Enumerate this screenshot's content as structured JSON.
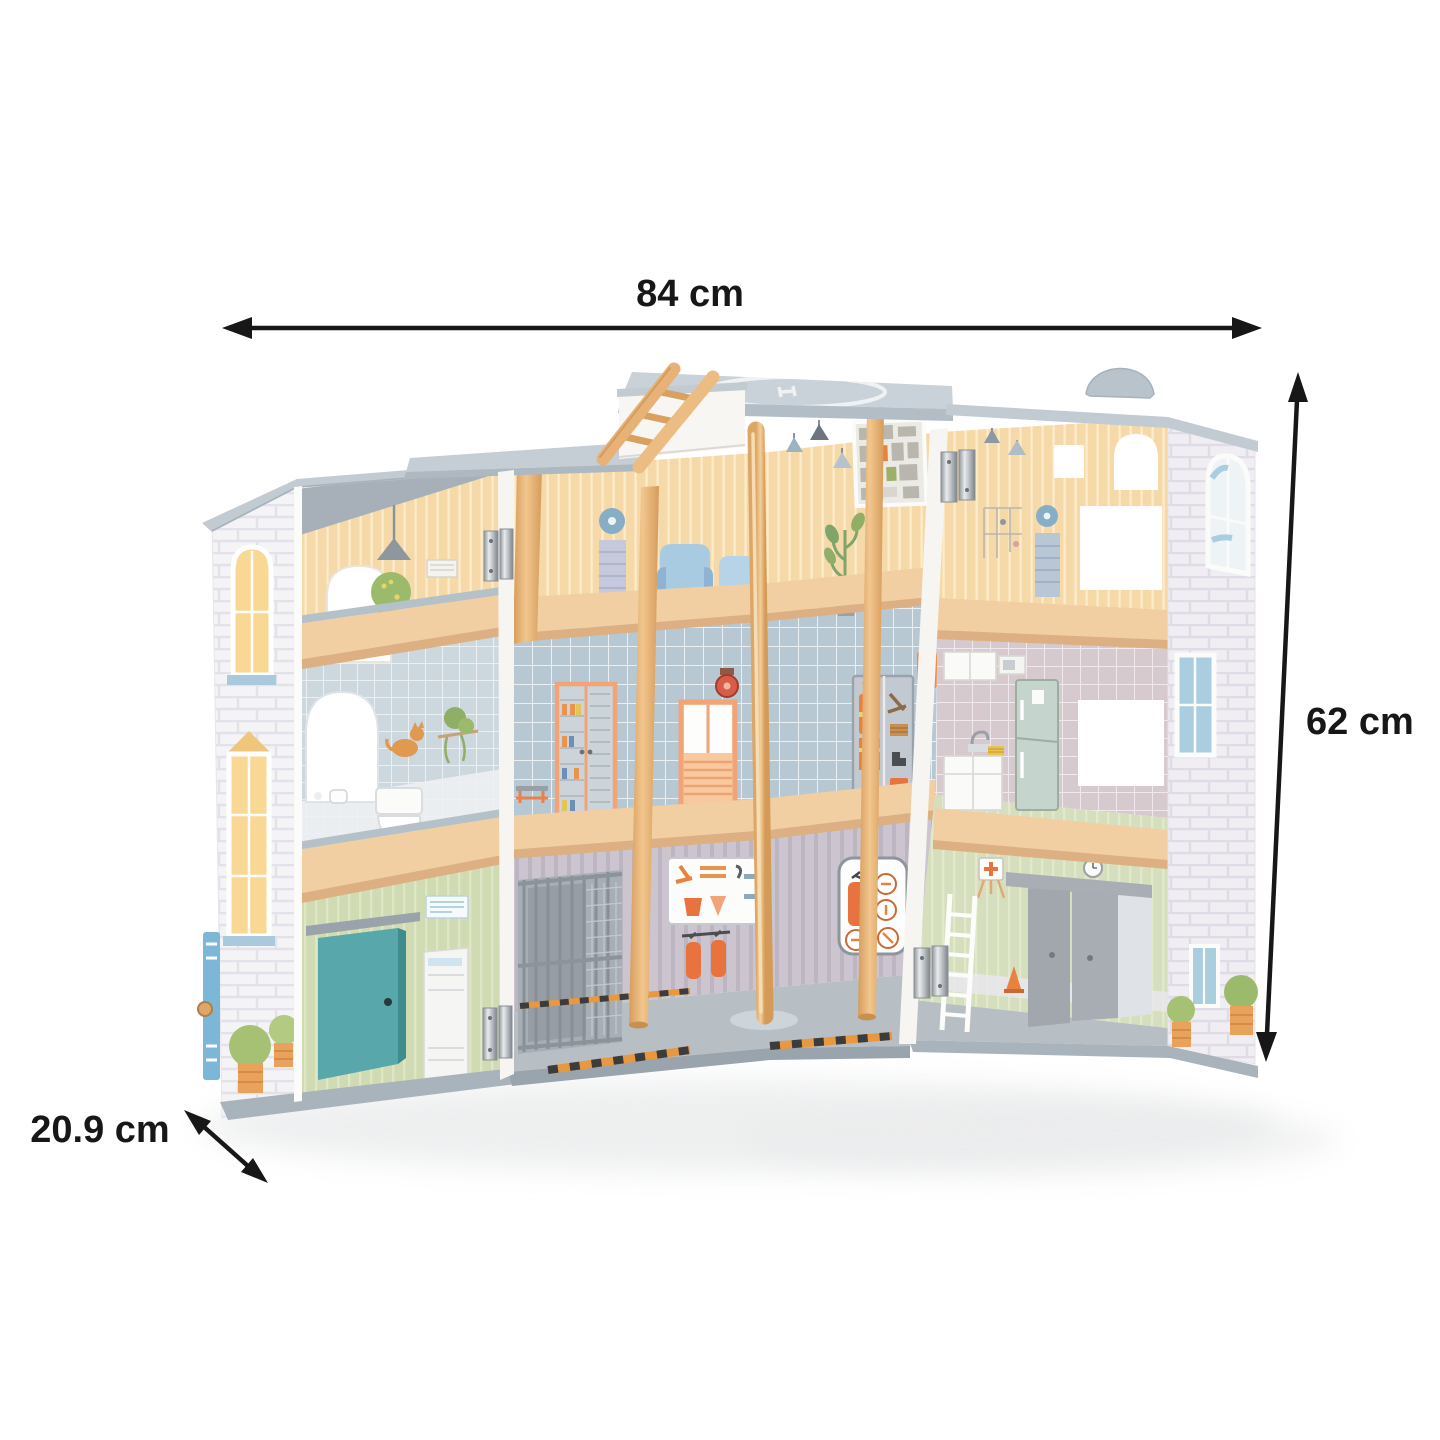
{
  "scene": {
    "type": "product photo",
    "subject": "Opened wooden toy fire-station dollhouse with three floors, helipad roof, wooden ladder, fire pole, garage and printed room interiors, shown on a white background with measurement arrows",
    "background_color": "#ffffff"
  },
  "annotations": {
    "width_label": "84 cm",
    "height_label": "62 cm",
    "depth_label": "20.9 cm",
    "text_color": "#171717"
  },
  "palette": {
    "roof_gray": "#c5ced5",
    "base_gray": "#a9b3bb",
    "wood_light": "#e9b87c",
    "floor_wood": "#f1cfa2",
    "wallpaper_peach": "#f6d9a8",
    "tile_blue": "#b9cad5",
    "tile_mauve": "#d6cacf",
    "wall_green": "#d0dbb4",
    "garage_gray": "#ccc5cf",
    "door_teal": "#58a8ab",
    "door_gray": "#a3a8af",
    "accent_orange": "#ea8a4d",
    "window_yellow": "#f8d894",
    "window_blue": "#aacde0"
  }
}
